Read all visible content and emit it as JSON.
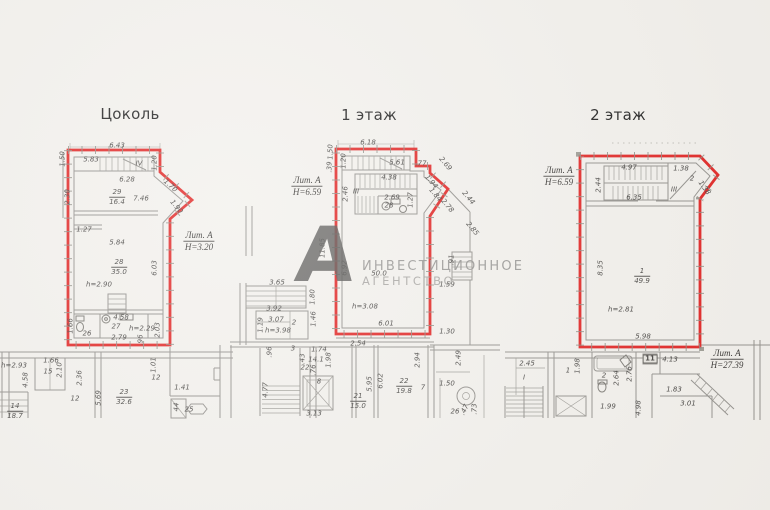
{
  "colors": {
    "outline_red": "#e01d1c",
    "line_gray": "#8f8d89",
    "paper": "#f2f0ec"
  },
  "plans": [
    {
      "title": "Цоколь"
    },
    {
      "title": "1 этаж"
    },
    {
      "title": "2 этаж"
    }
  ],
  "watermark": {
    "logo_letter": "А",
    "line1": "ИНВЕСТИЦИОННОЕ",
    "line2": "АГЕНТСТВО"
  },
  "dimension_labels": [
    {
      "t": "6.43",
      "x": 117,
      "y": 146
    },
    {
      "t": "1.50",
      "x": 63,
      "y": 159,
      "r": -90
    },
    {
      "t": "5.83",
      "x": 91,
      "y": 160
    },
    {
      "t": "IV",
      "x": 139,
      "y": 164
    },
    {
      "t": "1.20",
      "x": 155,
      "y": 163,
      "r": -90
    },
    {
      "t": "6.28",
      "x": 127,
      "y": 180
    },
    {
      "t": "1.70",
      "x": 170,
      "y": 186,
      "r": 42
    },
    {
      "ft": "29",
      "fb": "16.4",
      "x": 117,
      "y": 197
    },
    {
      "t": "7.46",
      "x": 141,
      "y": 199
    },
    {
      "t": "1.90",
      "x": 176,
      "y": 207,
      "r": 50
    },
    {
      "t": "2.30",
      "x": 68,
      "y": 197,
      "r": -90
    },
    {
      "t": "1.27",
      "x": 84,
      "y": 230
    },
    {
      "t": "5.84",
      "x": 117,
      "y": 243
    },
    {
      "ft": "Лит. А",
      "fb": "Н=3.20",
      "x": 199,
      "y": 241,
      "s": "floor"
    },
    {
      "ft": "28",
      "fb": "35.0",
      "x": 119,
      "y": 267
    },
    {
      "t": "6.03",
      "x": 155,
      "y": 268,
      "r": -90
    },
    {
      "t": "h=2.90",
      "x": 99,
      "y": 285
    },
    {
      "t": "1.66",
      "x": 71,
      "y": 326,
      "r": -90
    },
    {
      "t": "4.58",
      "x": 121,
      "y": 318
    },
    {
      "t": "27",
      "x": 116,
      "y": 327
    },
    {
      "t": "h=2.29",
      "x": 142,
      "y": 329
    },
    {
      "t": "2.03",
      "x": 158,
      "y": 330,
      "r": -90
    },
    {
      "t": "26",
      "x": 87,
      "y": 334
    },
    {
      "t": "2.79",
      "x": 119,
      "y": 338
    },
    {
      "t": ".96",
      "x": 141,
      "y": 340,
      "r": -90
    },
    {
      "t": "h=2.93",
      "x": 14,
      "y": 366
    },
    {
      "t": "1.66",
      "x": 51,
      "y": 361
    },
    {
      "t": "15",
      "x": 48,
      "y": 372
    },
    {
      "t": "2.10",
      "x": 60,
      "y": 370,
      "r": -90
    },
    {
      "t": "4.58",
      "x": 26,
      "y": 380,
      "r": -90
    },
    {
      "t": "2.36",
      "x": 80,
      "y": 378,
      "r": -90
    },
    {
      "t": "12",
      "x": 75,
      "y": 399
    },
    {
      "t": "5.69",
      "x": 99,
      "y": 398,
      "r": -90
    },
    {
      "ft": "23",
      "fb": "32.6",
      "x": 124,
      "y": 397
    },
    {
      "t": "1.01",
      "x": 154,
      "y": 365,
      "r": -90
    },
    {
      "t": "12",
      "x": 156,
      "y": 378
    },
    {
      "t": "1.41",
      "x": 182,
      "y": 388
    },
    {
      "t": "44",
      "x": 177,
      "y": 407,
      "r": -90
    },
    {
      "t": "25",
      "x": 189,
      "y": 410
    },
    {
      "ft": "14",
      "fb": "18.7",
      "x": 15,
      "y": 411
    },
    {
      "t": "6.18",
      "x": 368,
      "y": 143
    },
    {
      "t": "1.50",
      "x": 331,
      "y": 152,
      "r": -90
    },
    {
      "t": "1.20",
      "x": 344,
      "y": 161,
      "r": -90
    },
    {
      "t": ".39",
      "x": 330,
      "y": 167,
      "r": -90
    },
    {
      "t": "5.61",
      "x": 397,
      "y": 163
    },
    {
      "t": ".77",
      "x": 421,
      "y": 164
    },
    {
      "t": "2.69",
      "x": 445,
      "y": 164,
      "r": 50
    },
    {
      "t": "4.38",
      "x": 389,
      "y": 178
    },
    {
      "t": "III",
      "x": 356,
      "y": 192
    },
    {
      "t": "2.46",
      "x": 346,
      "y": 194,
      "r": -90
    },
    {
      "t": "2.69",
      "x": 392,
      "y": 198
    },
    {
      "t": "28",
      "x": 389,
      "y": 206
    },
    {
      "t": "1.27",
      "x": 411,
      "y": 200,
      "r": -90
    },
    {
      "t": "1.94",
      "x": 431,
      "y": 182,
      "r": 50
    },
    {
      "t": "1.84",
      "x": 435,
      "y": 195,
      "r": 50
    },
    {
      "t": "2.78",
      "x": 447,
      "y": 206,
      "r": 50
    },
    {
      "t": "2.44",
      "x": 468,
      "y": 198,
      "r": 50
    },
    {
      "t": "2.85",
      "x": 472,
      "y": 229,
      "r": 50
    },
    {
      "ft": "Лит. А",
      "fb": "Н=6.59",
      "x": 307,
      "y": 186,
      "s": "floor"
    },
    {
      "t": "11.85",
      "x": 323,
      "y": 248,
      "r": -90
    },
    {
      "t": "6.92",
      "x": 345,
      "y": 268,
      "r": -90
    },
    {
      "t": "50.0",
      "x": 379,
      "y": 274
    },
    {
      "t": "h=3.08",
      "x": 365,
      "y": 307
    },
    {
      "t": "6.01",
      "x": 386,
      "y": 324
    },
    {
      "t": ".91",
      "x": 452,
      "y": 260,
      "r": -90
    },
    {
      "t": "1.59",
      "x": 447,
      "y": 285
    },
    {
      "t": "1.30",
      "x": 447,
      "y": 332
    },
    {
      "t": "3.65",
      "x": 277,
      "y": 283
    },
    {
      "t": "3.92",
      "x": 274,
      "y": 309
    },
    {
      "t": "1.19",
      "x": 261,
      "y": 325,
      "r": -90
    },
    {
      "t": "3.07",
      "x": 276,
      "y": 320
    },
    {
      "t": "2",
      "x": 294,
      "y": 323
    },
    {
      "t": "h=3.98",
      "x": 278,
      "y": 331
    },
    {
      "t": "1.80",
      "x": 313,
      "y": 297,
      "r": -90
    },
    {
      "t": "1.46",
      "x": 314,
      "y": 319,
      "r": -90
    },
    {
      "t": ".96",
      "x": 270,
      "y": 352,
      "r": -90
    },
    {
      "t": "3",
      "x": 293,
      "y": 349
    },
    {
      "t": "1.74",
      "x": 319,
      "y": 350
    },
    {
      "t": "14.1",
      "x": 316,
      "y": 360
    },
    {
      "t": ".76",
      "x": 314,
      "y": 370,
      "r": -90
    },
    {
      "t": "1.98",
      "x": 329,
      "y": 360,
      "r": -90
    },
    {
      "t": "8",
      "x": 319,
      "y": 382
    },
    {
      "t": ".43",
      "x": 303,
      "y": 359,
      "r": -90
    },
    {
      "t": "22",
      "x": 305,
      "y": 368
    },
    {
      "t": "4.77",
      "x": 266,
      "y": 390,
      "r": -90
    },
    {
      "t": "2.54",
      "x": 358,
      "y": 344
    },
    {
      "ft": "21",
      "fb": "15.0",
      "x": 358,
      "y": 401
    },
    {
      "t": "5.95",
      "x": 370,
      "y": 384,
      "r": -90
    },
    {
      "t": "6.02",
      "x": 381,
      "y": 381,
      "r": -90
    },
    {
      "ft": "22",
      "fb": "19.8",
      "x": 404,
      "y": 386
    },
    {
      "t": "2.94",
      "x": 418,
      "y": 360,
      "r": -90
    },
    {
      "t": "7",
      "x": 423,
      "y": 388
    },
    {
      "t": "2.49",
      "x": 459,
      "y": 358,
      "r": -90
    },
    {
      "t": "1.50",
      "x": 447,
      "y": 384
    },
    {
      "t": "26",
      "x": 455,
      "y": 412
    },
    {
      "t": ".47",
      "x": 465,
      "y": 410,
      "r": -65
    },
    {
      "t": ".73",
      "x": 475,
      "y": 409,
      "r": -90
    },
    {
      "t": "3.13",
      "x": 314,
      "y": 414
    },
    {
      "ft": "Лит. А",
      "fb": "Н=6.59",
      "x": 559,
      "y": 176,
      "s": "floor"
    },
    {
      "t": "4.97",
      "x": 629,
      "y": 168
    },
    {
      "t": "2.44",
      "x": 599,
      "y": 185,
      "r": -90
    },
    {
      "t": "1.38",
      "x": 681,
      "y": 169
    },
    {
      "t": "2",
      "x": 692,
      "y": 179
    },
    {
      "t": "6.35",
      "x": 634,
      "y": 198
    },
    {
      "t": "III",
      "x": 674,
      "y": 190
    },
    {
      "t": "1.38",
      "x": 704,
      "y": 188,
      "r": 55
    },
    {
      "ft": "1",
      "fb": "49.9",
      "x": 642,
      "y": 276
    },
    {
      "t": "8.35",
      "x": 601,
      "y": 268,
      "r": -90
    },
    {
      "t": "h=2.81",
      "x": 621,
      "y": 310
    },
    {
      "t": "5.98",
      "x": 643,
      "y": 337
    },
    {
      "ft": "Лит. А",
      "fb": "Н=27.39",
      "x": 727,
      "y": 359,
      "s": "floor"
    },
    {
      "t": "4.13",
      "x": 670,
      "y": 360
    },
    {
      "t": "11",
      "x": 650,
      "y": 359,
      "s": "boxed"
    },
    {
      "t": "1.98",
      "x": 578,
      "y": 366,
      "r": -90
    },
    {
      "t": "2.45",
      "x": 527,
      "y": 364
    },
    {
      "t": "I",
      "x": 524,
      "y": 378
    },
    {
      "t": "1",
      "x": 568,
      "y": 371
    },
    {
      "t": "2",
      "x": 604,
      "y": 376
    },
    {
      "t": "2.64",
      "x": 617,
      "y": 378,
      "r": -90
    },
    {
      "t": "2.76",
      "x": 630,
      "y": 374,
      "r": -90
    },
    {
      "t": "1.99",
      "x": 608,
      "y": 407
    },
    {
      "t": "4.98",
      "x": 639,
      "y": 408,
      "r": -90
    },
    {
      "t": "1.83",
      "x": 674,
      "y": 390
    },
    {
      "t": "3.01",
      "x": 688,
      "y": 404
    }
  ]
}
